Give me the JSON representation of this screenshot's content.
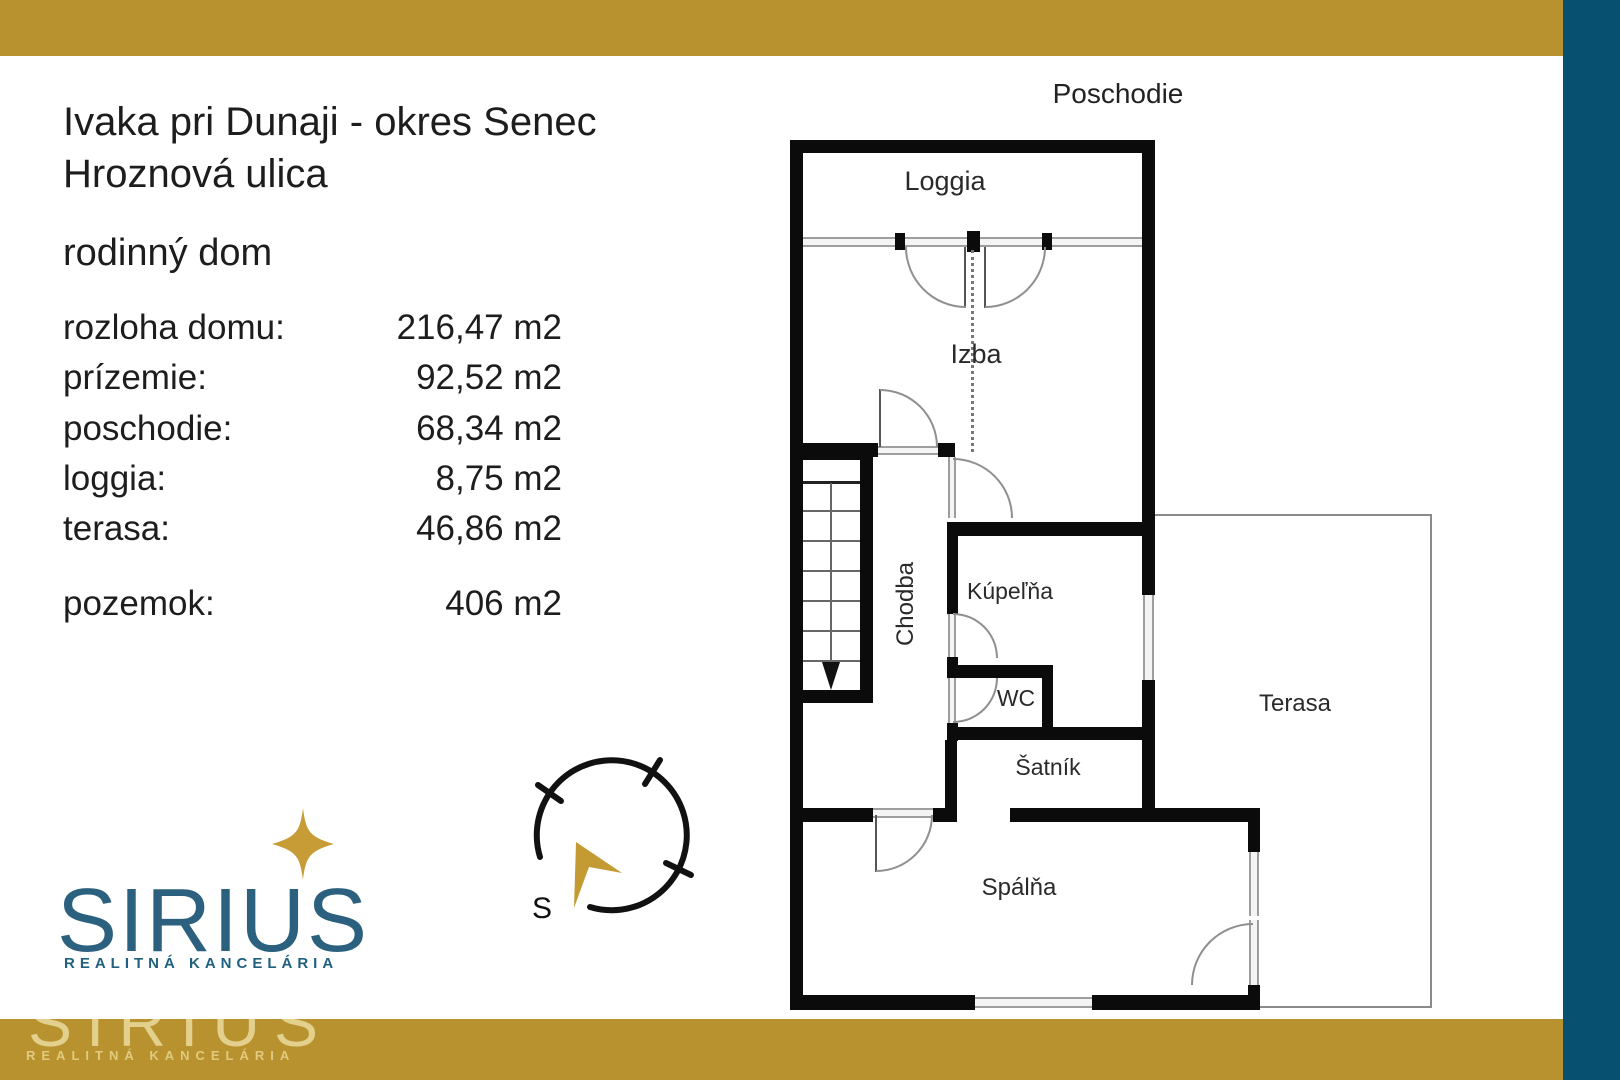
{
  "colors": {
    "gold_bar": "#B7922E",
    "teal_bar": "#07506F",
    "logo_teal": "#2B617F",
    "star_gold": "#C79B35",
    "arrow_gold": "#C49B33",
    "watermark_gold": "#EBDB9E",
    "text_dark": "#1D1D1D",
    "wall_black": "#0B0B0B",
    "glass_gray": "#9E9E9E"
  },
  "header": {
    "location_line1": "Ivaka pri Dunaji - okres Senec",
    "location_line2": "Hroznová ulica",
    "property_type": "rodinný dom"
  },
  "details": {
    "rows": [
      {
        "label": "rozloha domu:",
        "value": "216,47 m2"
      },
      {
        "label": "prízemie:",
        "value": "92,52 m2"
      },
      {
        "label": "poschodie:",
        "value": "68,34 m2"
      },
      {
        "label": "loggia:",
        "value": "8,75 m2"
      },
      {
        "label": "terasa:",
        "value": "46,86 m2"
      }
    ],
    "pozemok": {
      "label": "pozemok:",
      "value": "406 m2"
    }
  },
  "logo": {
    "name": "SIRIUS",
    "tagline": "REALITNÁ KANCELÁRIA"
  },
  "watermark": {
    "name": "SIRIUS",
    "tagline": "REALITNÁ KANCELÁRIA"
  },
  "compass": {
    "south_label": "S"
  },
  "floorplan": {
    "title": "Poschodie",
    "rooms": {
      "loggia": "Loggia",
      "izba": "Izba",
      "chodba": "Chodba",
      "kupelna": "Kúpeľňa",
      "wc": "WC",
      "satnik": "Šatník",
      "terasa": "Terasa",
      "spalna": "Spálňa"
    }
  }
}
